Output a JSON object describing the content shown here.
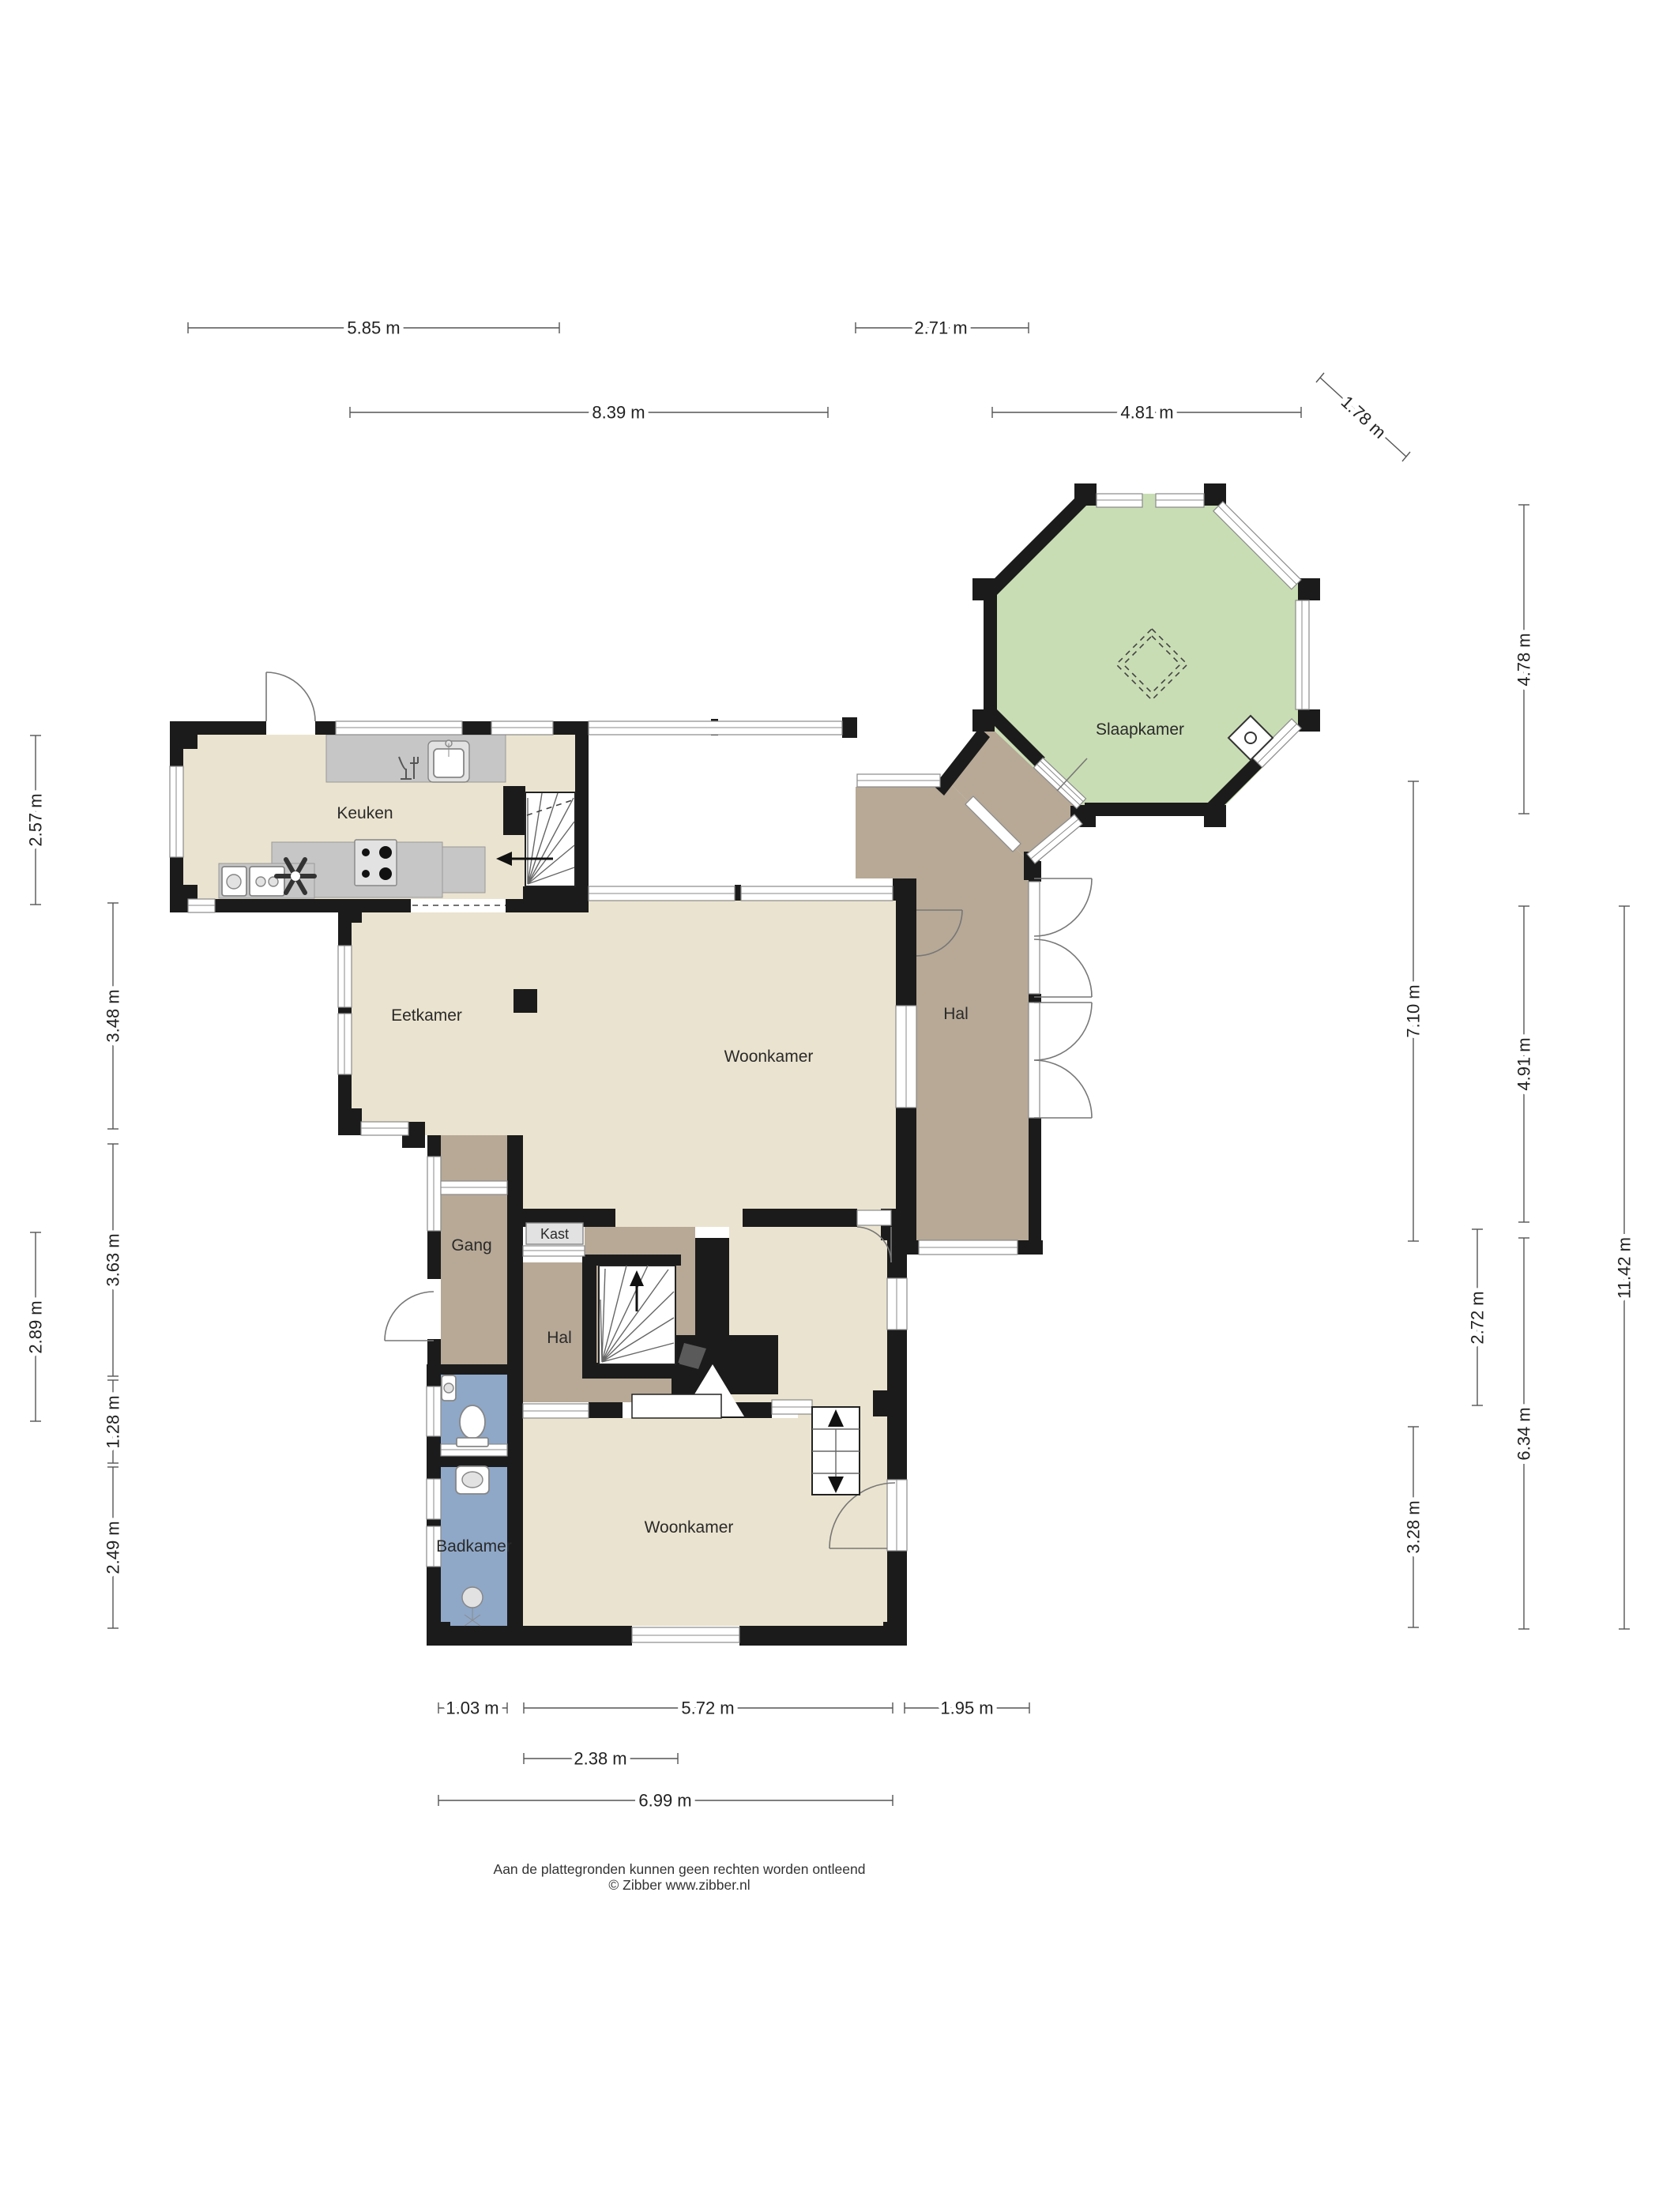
{
  "rooms": {
    "keuken": "Keuken",
    "eetkamer": "Eetkamer",
    "woonkamer_boven": "Woonkamer",
    "hal_boven": "Hal",
    "slaapkamer": "Slaapkamer",
    "gang": "Gang",
    "kast": "Kast",
    "hal_onder": "Hal",
    "woonkamer_onder": "Woonkamer",
    "badkamer": "Badkamer"
  },
  "dimensions": {
    "top1": "5.85 m",
    "top2": "2.71 m",
    "top3": "8.39 m",
    "top4": "4.81 m",
    "diag": "1.78 m",
    "l1": "2.57 m",
    "l2": "3.48 m",
    "l3": "3.63 m",
    "l4": "2.89 m",
    "l5": "1.28 m",
    "l6": "2.49 m",
    "r1": "4.78 m",
    "r2": "7.10 m",
    "r3": "4.91 m",
    "r4": "2.72 m",
    "r5": "11.42 m",
    "r6": "6.34 m",
    "r7": "3.28 m",
    "b1": "1.03 m",
    "b2": "5.72 m",
    "b3": "1.95 m",
    "b4": "2.38 m",
    "b5": "6.99 m"
  },
  "footer": {
    "line1": "Aan de plattegronden kunnen geen rechten worden ontleend",
    "line2": "© Zibber www.zibber.nl"
  },
  "colors": {
    "wall": "#1b1b1b",
    "floor_beige": "#eae3cf",
    "floor_taupe": "#b7a996",
    "floor_green": "#c9ddb4",
    "floor_blue": "#8fa8c8",
    "counter_gray": "#c6c6c6",
    "accent_line": "#555555"
  }
}
